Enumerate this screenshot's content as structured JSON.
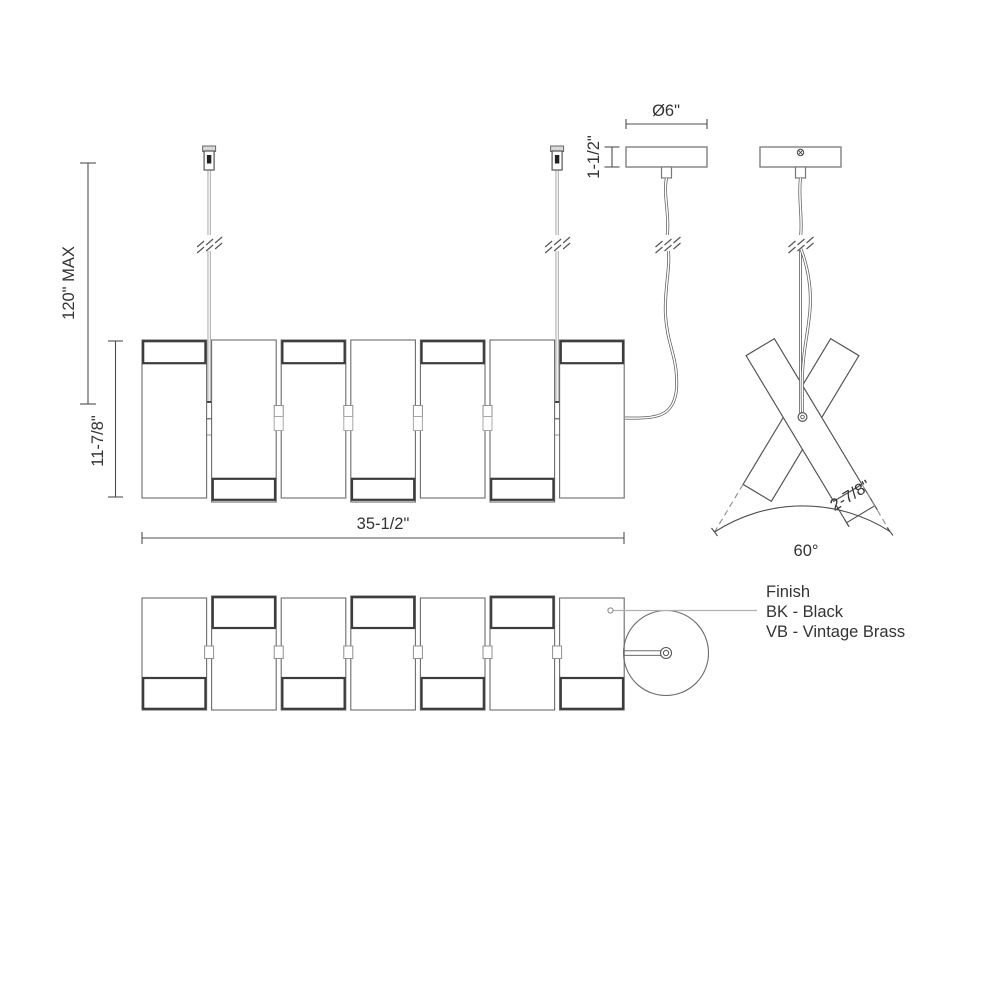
{
  "colors": {
    "background": "#ffffff",
    "line_dark": "#3c3c3c",
    "line_medium": "#6b6b6b",
    "line_light": "#8f8f8f",
    "text": "#333333"
  },
  "dimensions": {
    "front": {
      "max_height": "120\" MAX",
      "body_height": "11-7/8\"",
      "width": "35-1/2\""
    },
    "canopy": {
      "diameter": "Ø6\"",
      "height": "1-1/2\""
    },
    "side": {
      "panel_width": "2-7/8\"",
      "spread_angle": "60°"
    }
  },
  "finish_legend": {
    "title": "Finish",
    "options": [
      "BK - Black",
      "VB - Vintage Brass"
    ]
  },
  "icons": {
    "screw": "cross-screw-head",
    "cable_break": "diagonal-break-marks"
  }
}
